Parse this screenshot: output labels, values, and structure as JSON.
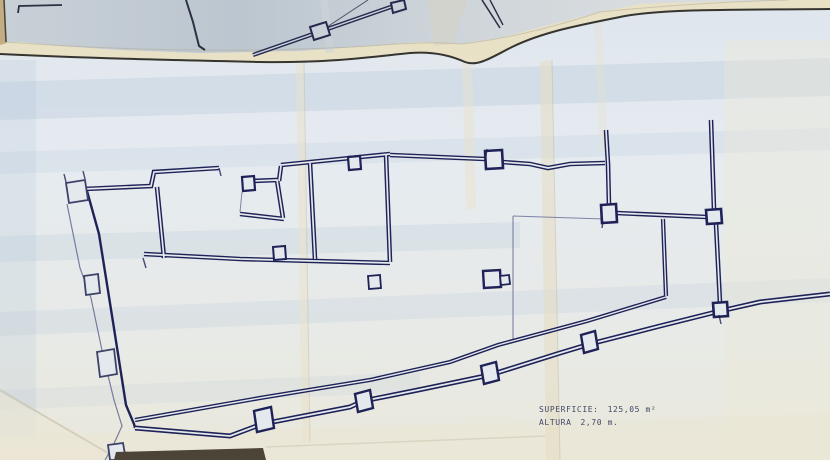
{
  "annotations": {
    "superficie": {
      "label": "SUPERFICIE:",
      "value": "125,05 m²"
    },
    "altura": {
      "label": "ALTURA",
      "value": "2,70 m."
    }
  },
  "colors": {
    "plan_ink": "#1f2257",
    "upper_sheet_ink": "#2d3042",
    "border_ink": "#35342f",
    "thin_line": "#626892",
    "paper_blue_white": "#e4e9ee",
    "paper_band_blue": "#aec3d8",
    "upper_sheet_paper": "#c9d2d9",
    "sheet_edge_cream": "#e9e1c6",
    "table_tan": "#c7b28b",
    "bottom_shadow_strip": "#4c4437"
  }
}
